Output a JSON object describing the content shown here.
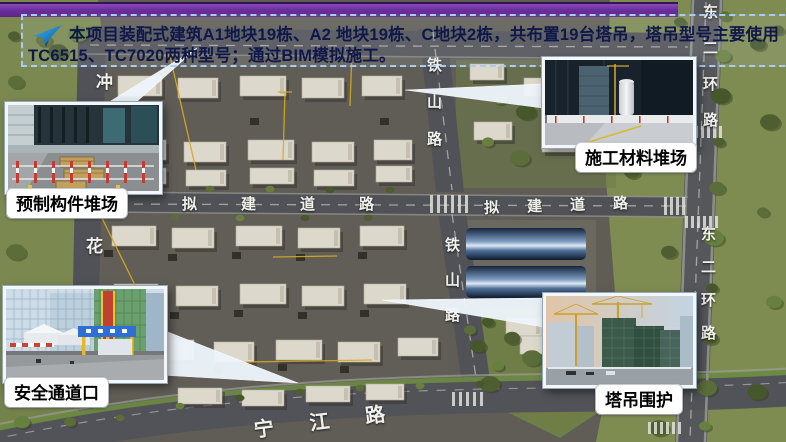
{
  "banner": {
    "line1": "本项目装配式建筑A1地块19栋、A2 地块19栋、C地块2栋，共布置19台塔吊，塔吊型号主要使用",
    "line2": "TC6515、TC7020两种型号；通过BIM模拟施工。"
  },
  "callouts": {
    "precast_yard": {
      "label": "预制构件堆场"
    },
    "material_yard": {
      "label": "施工材料堆场"
    },
    "safety_entrance": {
      "label": "安全通道口"
    },
    "crane_enclosure": {
      "label": "塔吊围护"
    }
  },
  "map_labels": {
    "planned_road_west": "拟建道路",
    "planned_road_east": "拟建道路",
    "tieshan_road_north": "铁山路",
    "tieshan_road_south": "铁山路",
    "east_second_ring_north": "东二环路",
    "east_second_ring_south": "东二环路",
    "hua_partial": "花",
    "chong_partial": "冲",
    "ningjiang_road": "宁江路"
  },
  "colors": {
    "banner_text": "#0f1848",
    "banner_border": "#a9cdf0",
    "top_bar_purple": "#6c2f9e",
    "crane_line_yellow": "#d9a91f",
    "callout_label_bg": "#ffffff",
    "callout_label_text": "#000000"
  }
}
